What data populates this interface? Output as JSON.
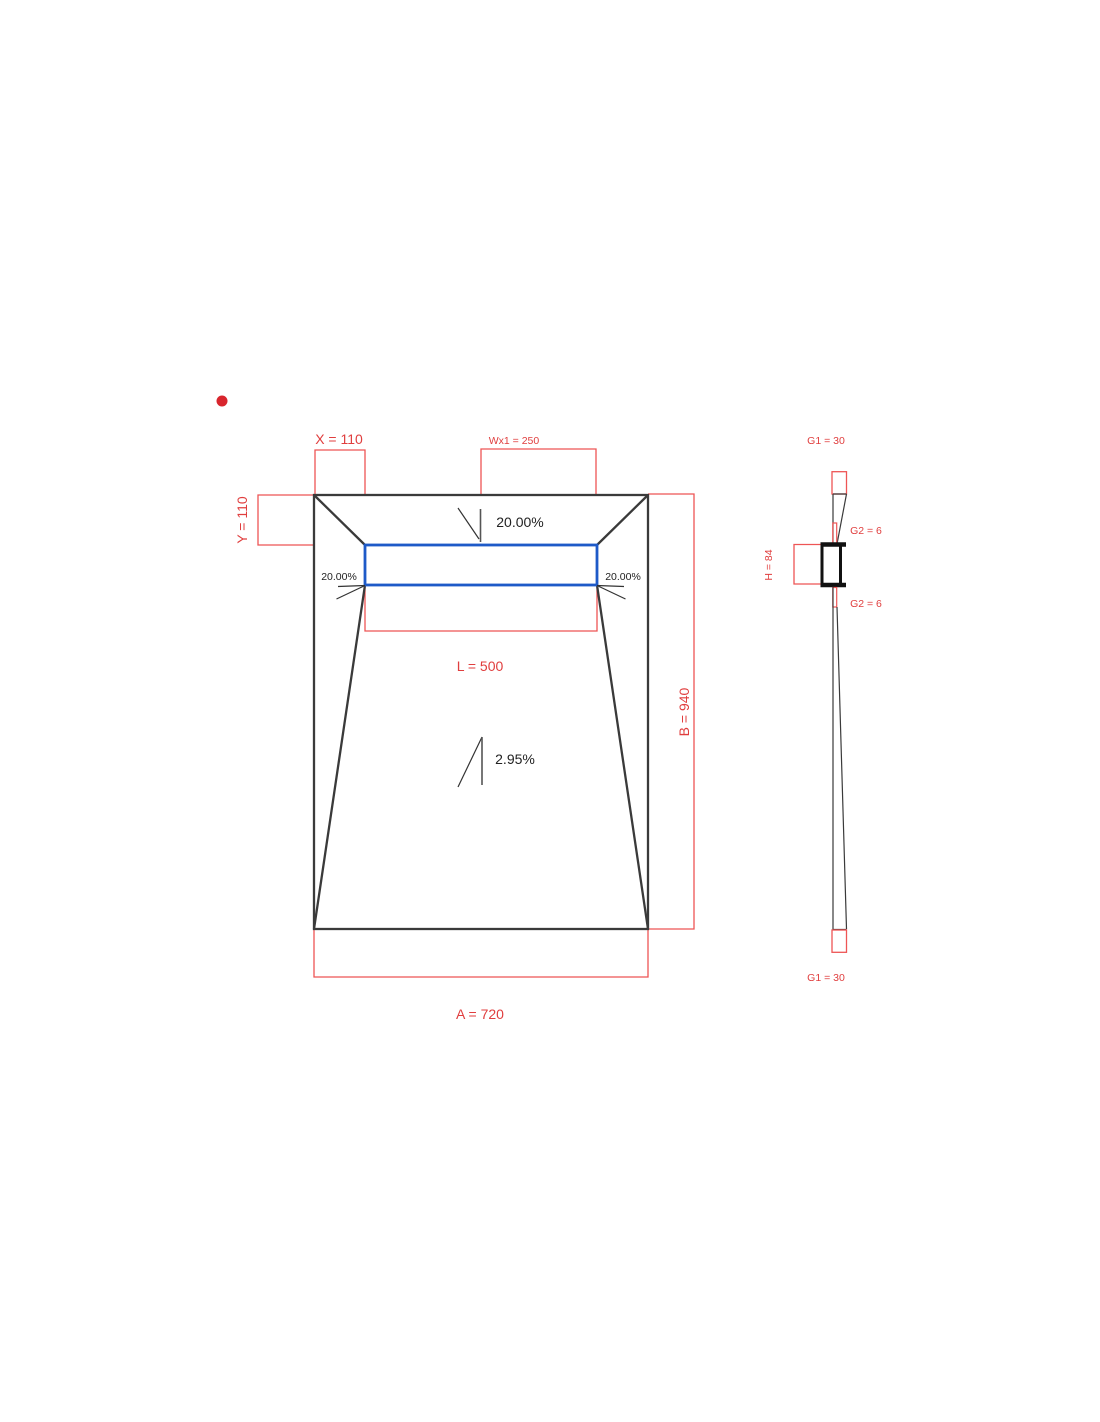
{
  "plan_view": {
    "dim_x": "X = 110",
    "dim_wx1": "Wx1 = 250",
    "dim_y": "Y = 110",
    "dim_l": "L = 500",
    "dim_b": "B = 940",
    "dim_a": "A = 720",
    "slope_top": "20.00%",
    "slope_left": "20.00%",
    "slope_right": "20.00%",
    "slope_main": "2.95%"
  },
  "profile_view": {
    "dim_g1_top": "G1 = 30",
    "dim_g2_top": "G2 = 6",
    "dim_g2_bottom": "G2 = 6",
    "dim_g1_bottom": "G1 = 30",
    "dim_h": "H = 84"
  },
  "colors": {
    "dimension_line_red": "#ee5555",
    "dimension_text_red": "#e03e3e",
    "outline_dark": "#3a3a3a",
    "drain_channel_blue": "#1e5ac8",
    "marker_dot_red": "#d8252d",
    "background": "#ffffff"
  }
}
